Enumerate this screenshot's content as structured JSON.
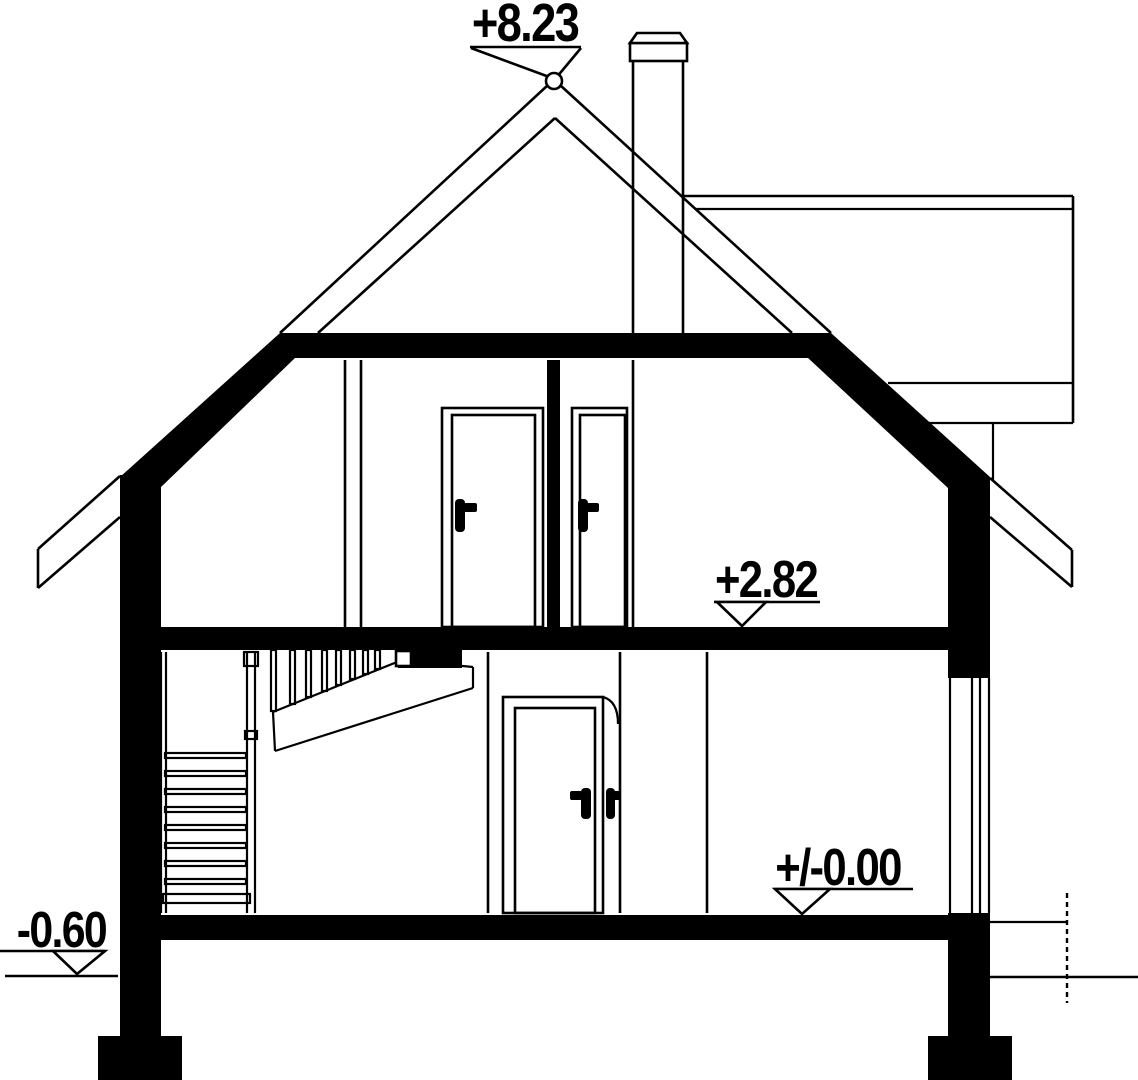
{
  "drawing": {
    "type": "architectural-cross-section",
    "description": "Vertical section through a two-storey gabled house with chimney, attic rooms, staircase, doors and right-side window",
    "levels": {
      "ridge": "+8.23",
      "first_floor": "+2.82",
      "ground_floor": "+/-0.00",
      "exterior_grade": "-0.60"
    },
    "colors": {
      "ink": "#000000",
      "paper": "#ffffff"
    }
  }
}
